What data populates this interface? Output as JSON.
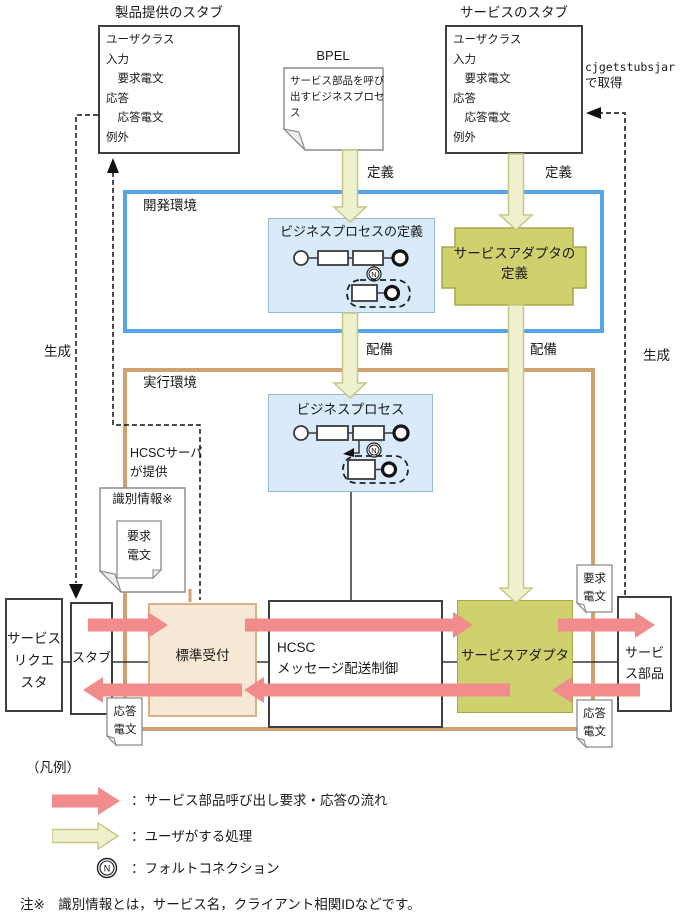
{
  "colors": {
    "pink": "#F28B8B",
    "olive_fill": "#EFF0CD",
    "olive_border": "#C6C783",
    "adapter_fill": "#CFD06E",
    "adapter_border": "#A6A748",
    "lightblue_fill": "#D9EBFA",
    "lightblue_border": "#94B9D9",
    "dev_border": "#55A5E8",
    "run_border": "#CFA070",
    "reception_fill": "#F7E8D6",
    "reception_border": "#DCAF85"
  },
  "top": {
    "left_stub_title": "製品提供のスタブ",
    "right_stub_title": "サービスのスタブ",
    "stub_content": "ユーザクラス\n入力\n　要求電文\n応答\n　応答電文\n例外",
    "bpel_label": "BPEL",
    "bpel_doc_text": "サービス部品を呼び\n出すビジネスプロセ\nス",
    "cjget_line1": "cjgetstubsjar",
    "cjget_line2": "で取得"
  },
  "labels": {
    "define_left": "定義",
    "define_right": "定義",
    "deploy_left": "配備",
    "deploy_right": "配備",
    "generate_left": "生成",
    "generate_right": "生成",
    "dev_env": "開発環境",
    "run_env": "実行環境",
    "hcsc_provides": "HCSCサーバ\nが提供",
    "bp_definition": "ビジネスプロセスの定義",
    "bp_runtime": "ビジネスプロセス",
    "adapter_definition": "サービスアダプタの\n定義",
    "id_info": "識別情報※"
  },
  "docs": {
    "request": "要求\n電文",
    "response": "応答\n電文"
  },
  "bottom": {
    "requester": "サービス\nリクエ\nスタ",
    "stub": "スタブ",
    "reception": "標準受付",
    "hcsc": "HCSC\nメッセージ配送制御",
    "adapter": "サービスアダプタ",
    "parts": "サービ\nス部品"
  },
  "fault_symbol": "N",
  "legend": {
    "title": "（凡例）",
    "pink_arrow_text": "：サービス部品呼び出し要求・応答の流れ",
    "olive_arrow_text": "：ユーザがする処理",
    "fault_text": "：フォルトコネクション",
    "note": "注※　識別情報とは，サービス名，クライアント相関IDなどです。"
  }
}
